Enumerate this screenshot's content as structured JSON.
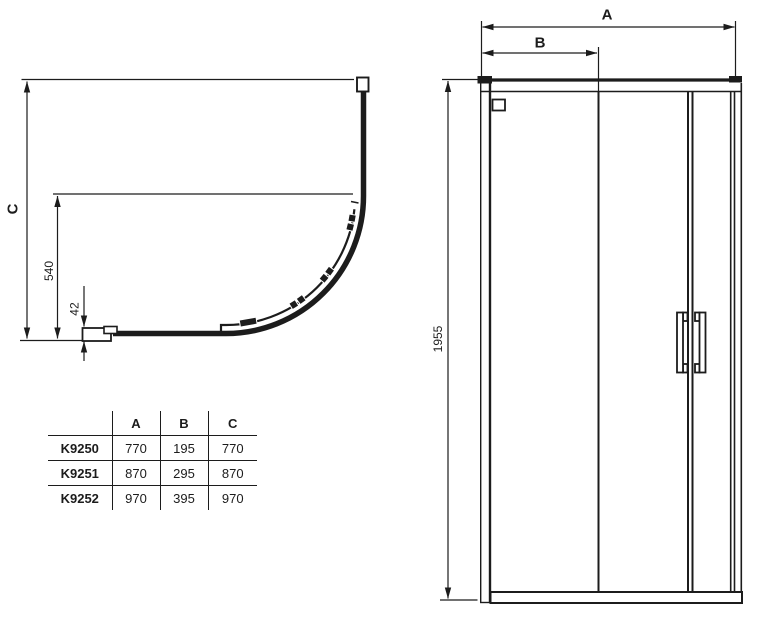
{
  "plan_view": {
    "dim_c_label": "C",
    "dim_540_label": "540",
    "dim_42_label": "42"
  },
  "elevation_view": {
    "dim_a_label": "A",
    "dim_b_label": "B",
    "dim_height_label": "1955"
  },
  "table": {
    "headers": [
      "A",
      "B",
      "C"
    ],
    "rows": [
      {
        "model": "K9250",
        "cells": [
          "770",
          "195",
          "770"
        ]
      },
      {
        "model": "K9251",
        "cells": [
          "870",
          "295",
          "870"
        ]
      },
      {
        "model": "K9252",
        "cells": [
          "970",
          "395",
          "970"
        ]
      }
    ]
  },
  "colors": {
    "line": "#1c1c1c",
    "background": "#ffffff"
  }
}
